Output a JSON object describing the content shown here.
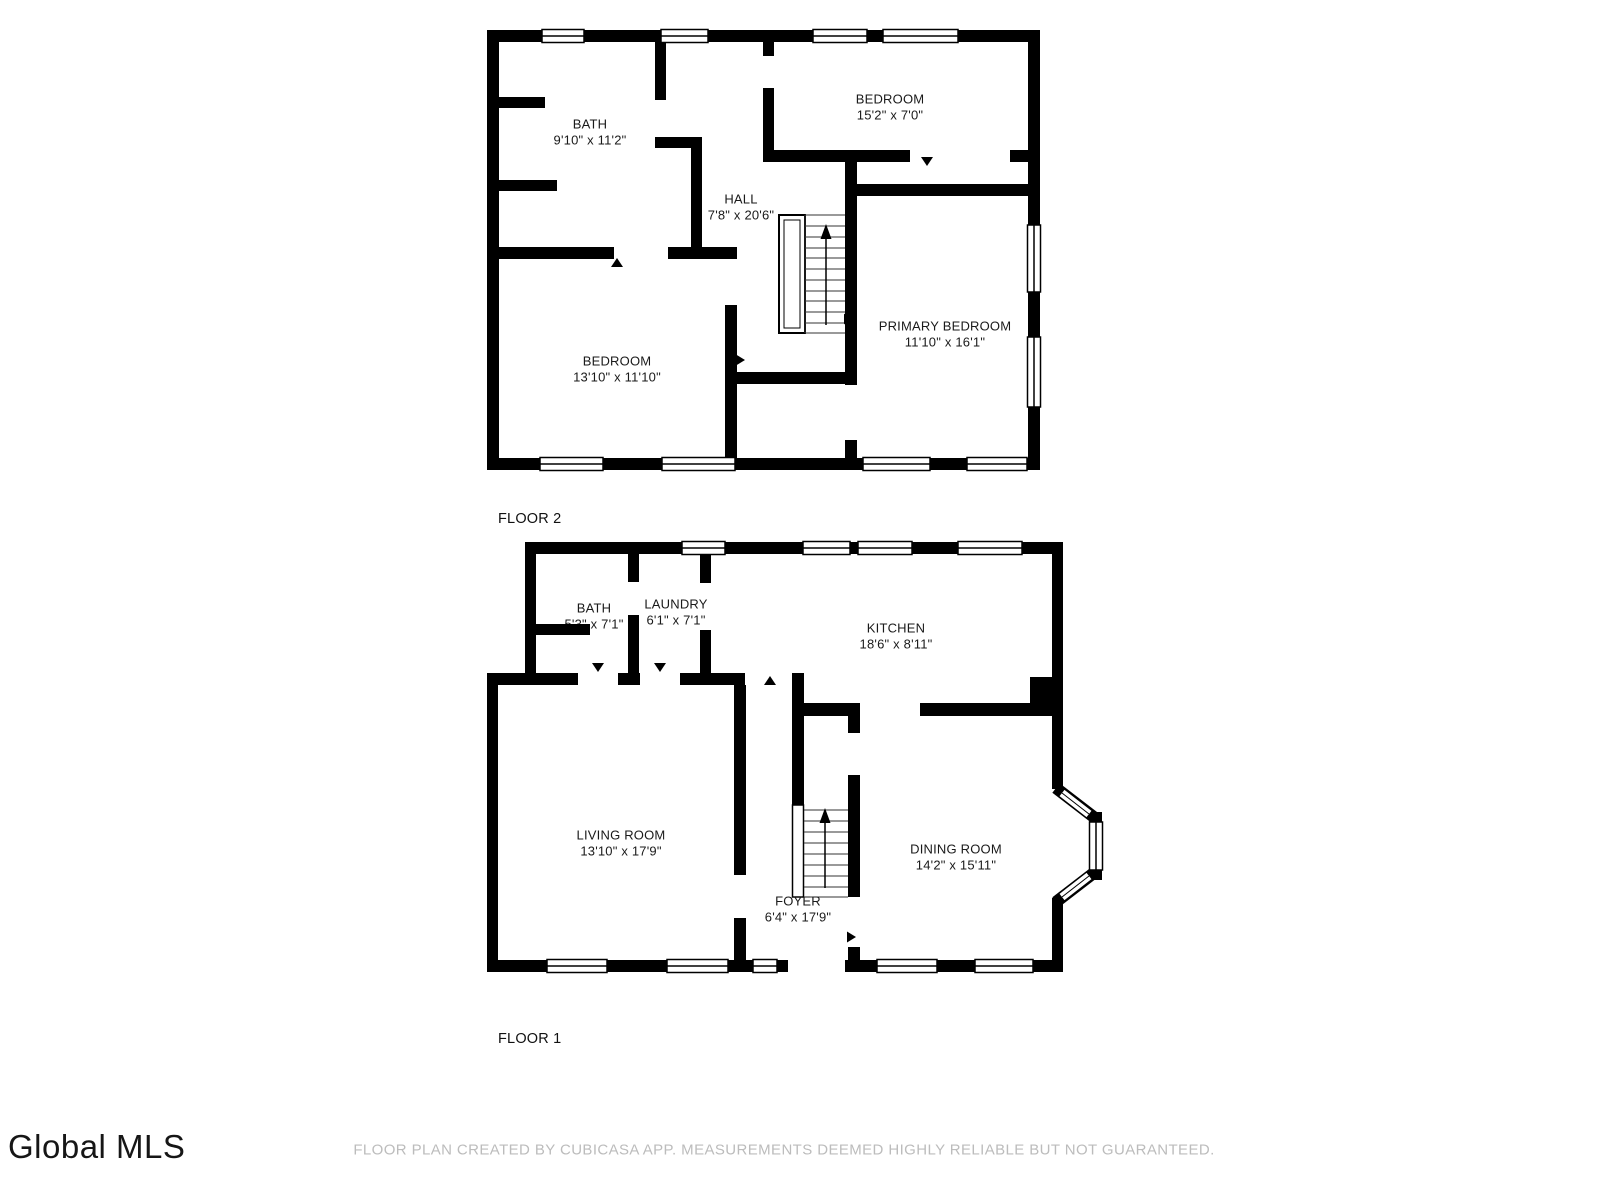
{
  "floors": [
    {
      "label": "FLOOR 2",
      "rooms": [
        {
          "name": "BATH",
          "dims": "9'10\" x 11'2\""
        },
        {
          "name": "BEDROOM",
          "dims": "15'2\" x 7'0\""
        },
        {
          "name": "HALL",
          "dims": "7'8\" x 20'6\""
        },
        {
          "name": "PRIMARY BEDROOM",
          "dims": "11'10\" x 16'1\""
        },
        {
          "name": "BEDROOM",
          "dims": "13'10\" x 11'10\""
        }
      ]
    },
    {
      "label": "FLOOR 1",
      "rooms": [
        {
          "name": "BATH",
          "dims": "5'3\" x 7'1\""
        },
        {
          "name": "LAUNDRY",
          "dims": "6'1\" x 7'1\""
        },
        {
          "name": "KITCHEN",
          "dims": "18'6\" x 8'11\""
        },
        {
          "name": "LIVING ROOM",
          "dims": "13'10\" x 17'9\""
        },
        {
          "name": "DINING ROOM",
          "dims": "14'2\" x 15'11\""
        },
        {
          "name": "FOYER",
          "dims": "6'4\" x 17'9\""
        }
      ]
    }
  ],
  "footer": {
    "logo_text": "Global MLS",
    "disclaimer": "FLOOR PLAN CREATED BY CUBICASA APP. MEASUREMENTS DEEMED HIGHLY RELIABLE BUT NOT GUARANTEED."
  },
  "colors": {
    "wall": "#000000",
    "label_text": "#1a1a1a",
    "disclaimer_text": "#bcbcbc",
    "background": "#ffffff"
  }
}
